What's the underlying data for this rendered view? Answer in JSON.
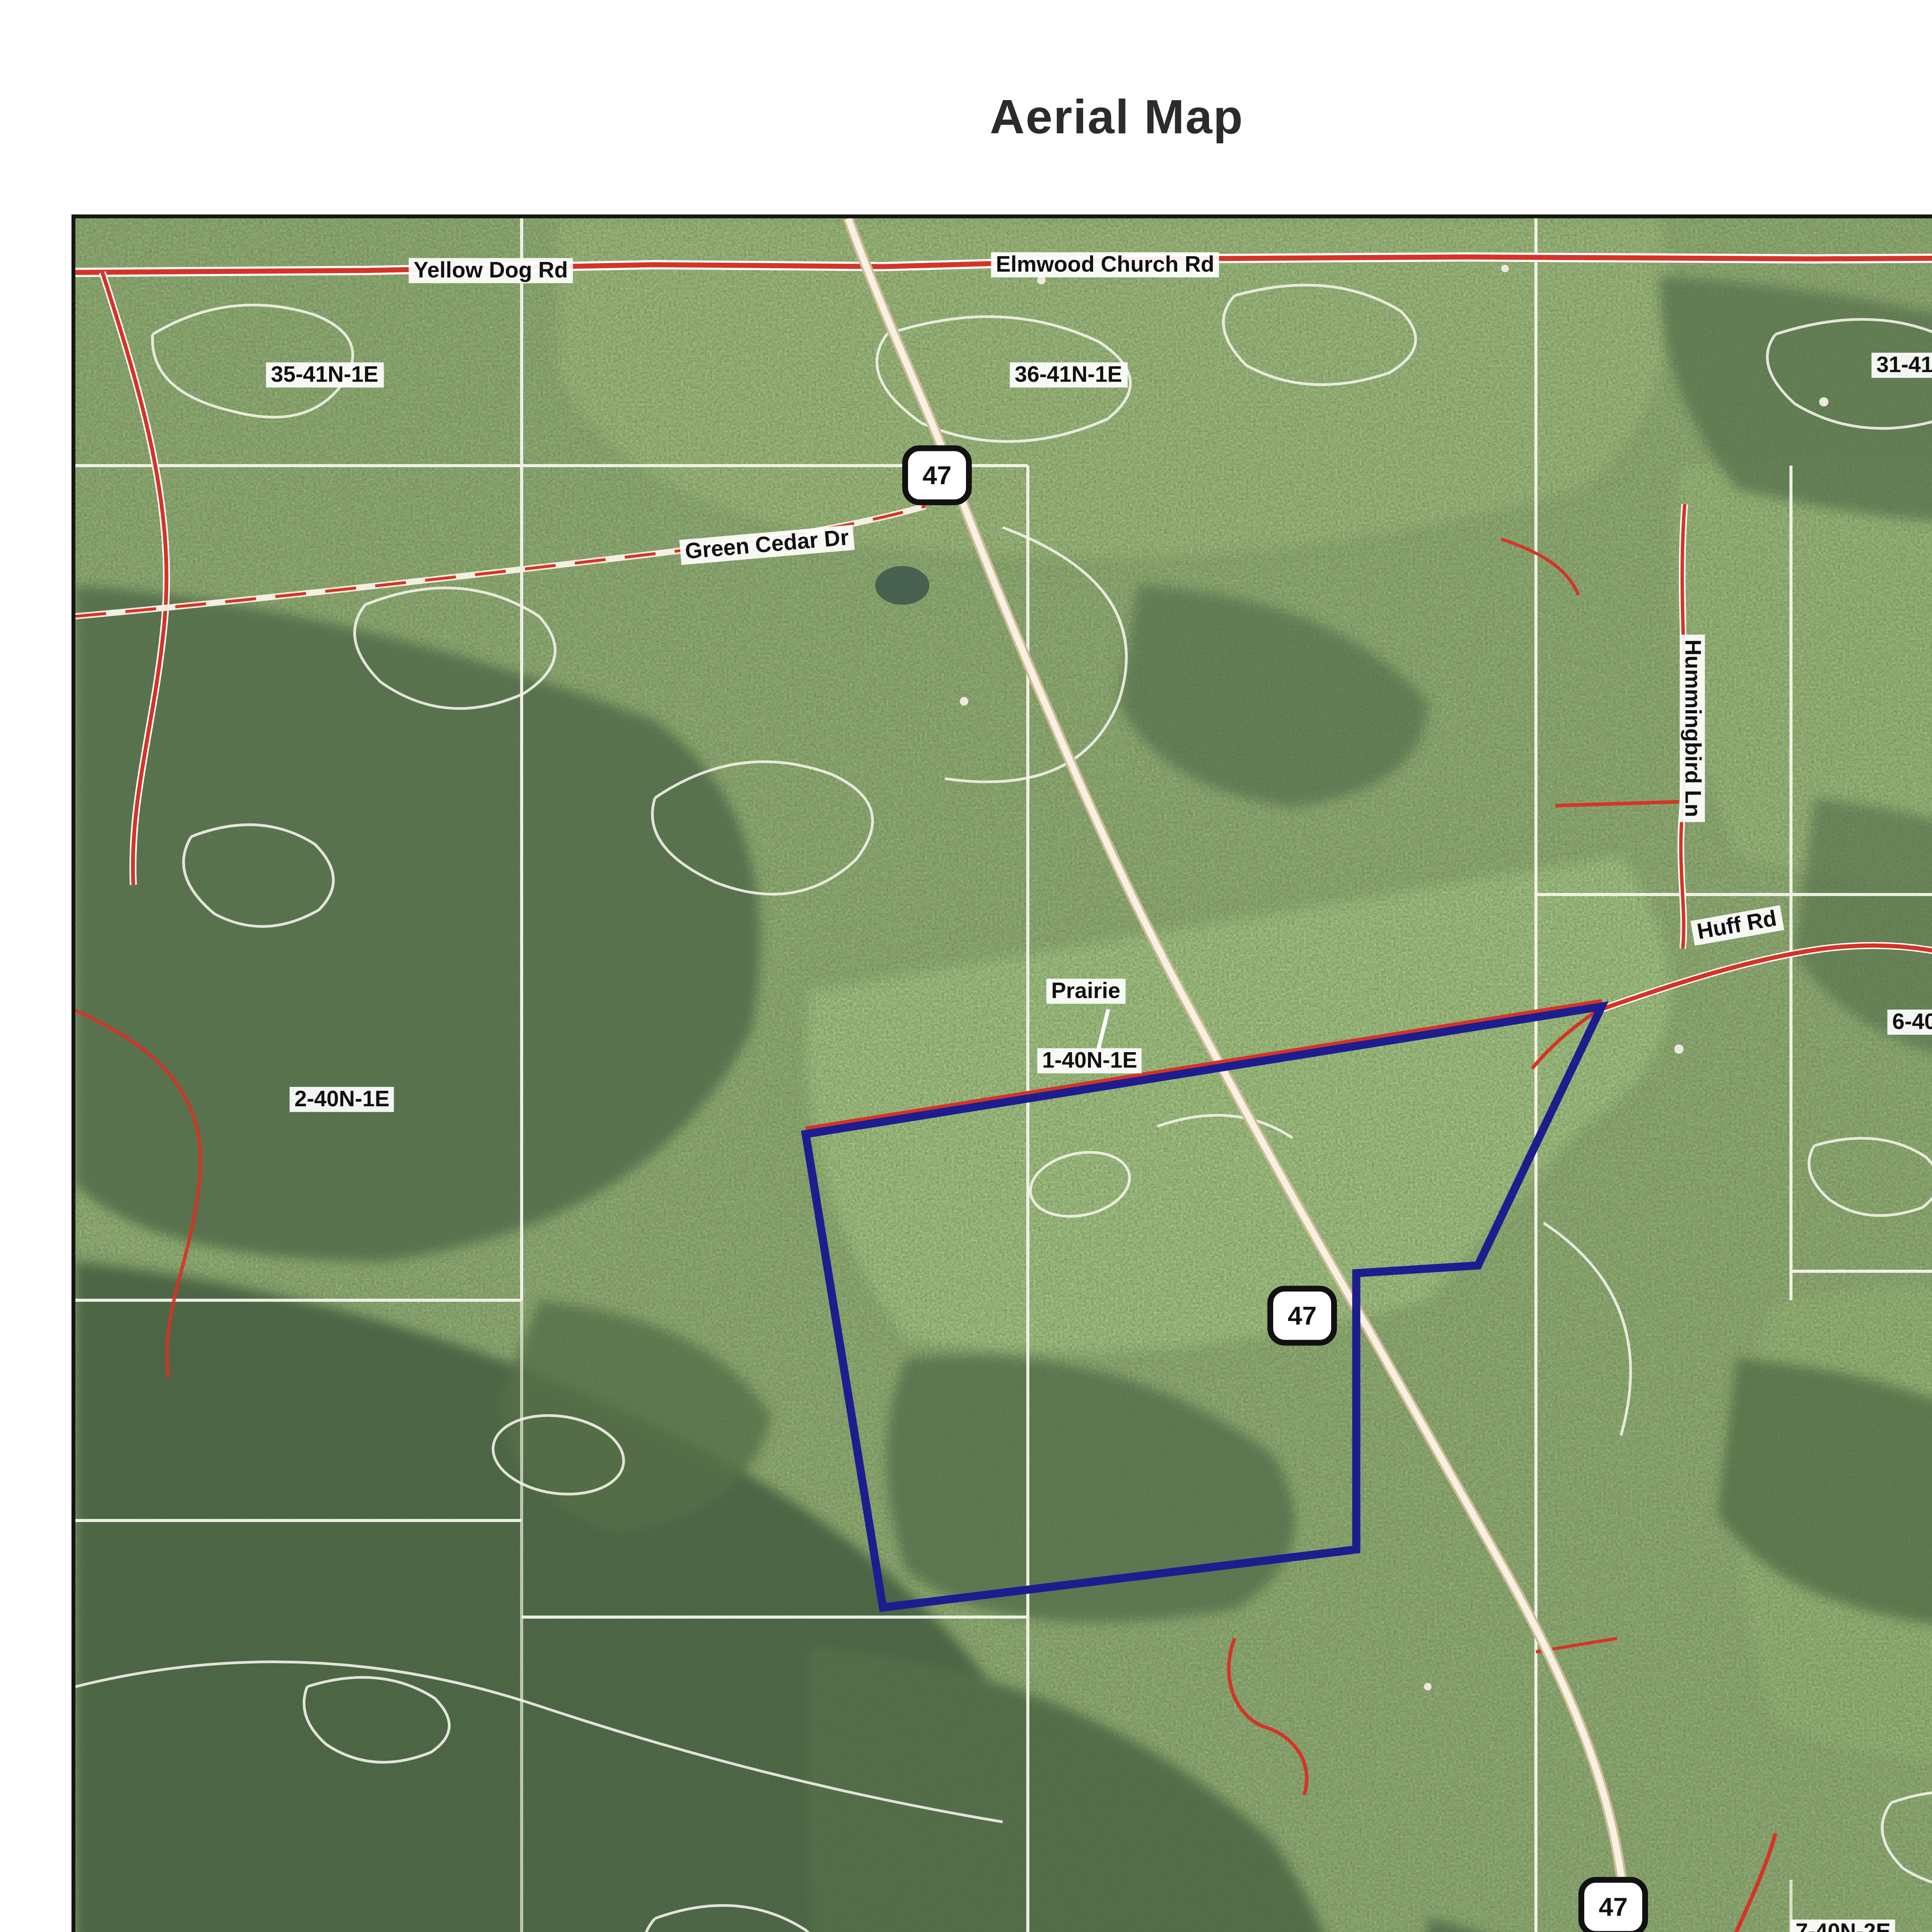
{
  "title": "Aerial Map",
  "map": {
    "shield": "47",
    "copyright": "\u00a92019 AgriData, Inc.",
    "labels": {
      "yellow_dog": "Yellow Dog Rd",
      "elmwood": "Elmwood Church Rd",
      "green_cedar": "Green Cedar Dr",
      "hummingbird": "Hummingbird Ln",
      "huff": "Huff Rd",
      "prairie": "Prairie",
      "s35": "35-41N-1E",
      "s36": "36-41N-1E",
      "s31": "31-41N-2E",
      "s2": "2-40N-1E",
      "s1": "1-40N-1E",
      "s6": "6-40N-2E",
      "s11": "11-40N-1E",
      "s12": "12-40N-1E",
      "s7": "7-40N-2E"
    },
    "colors": {
      "boundary": "#1d1d8f",
      "road_red": "#d63327",
      "highway_fill": "#f8f1e1",
      "field_line": "#f3f2e9"
    }
  },
  "footer": {
    "map_center": "Map Center: 38\u00b0 13' 37.99,  -90\u00b0 51' 55.11",
    "tract": "1-40N-1E",
    "county": "Franklin County",
    "state": "Missouri",
    "scale": {
      "zero": "0ft",
      "mid": "1719ft",
      "max": "3438ft"
    },
    "compass": {
      "n": "N",
      "e": "E",
      "s": "S",
      "w": "W"
    },
    "date": "2/22/2020",
    "logo": {
      "monogram": "PFRG",
      "name": "PREMIER FARM",
      "tagline": "REALTY GROUP & AUCTION"
    },
    "provided_by": "Maps Provided By:",
    "surety": {
      "name": "surety",
      "reg": "\u00ae",
      "tagline": "CUSTOMIZED ONLINE MAPPING"
    },
    "agridata_copyright": "\u00a9 AgriData, Inc. 2019",
    "agridata_url": "www.AgriDataInc.com",
    "disclaimer": "Field borders provided by Farm Service Agency as of 5/21/2008."
  }
}
